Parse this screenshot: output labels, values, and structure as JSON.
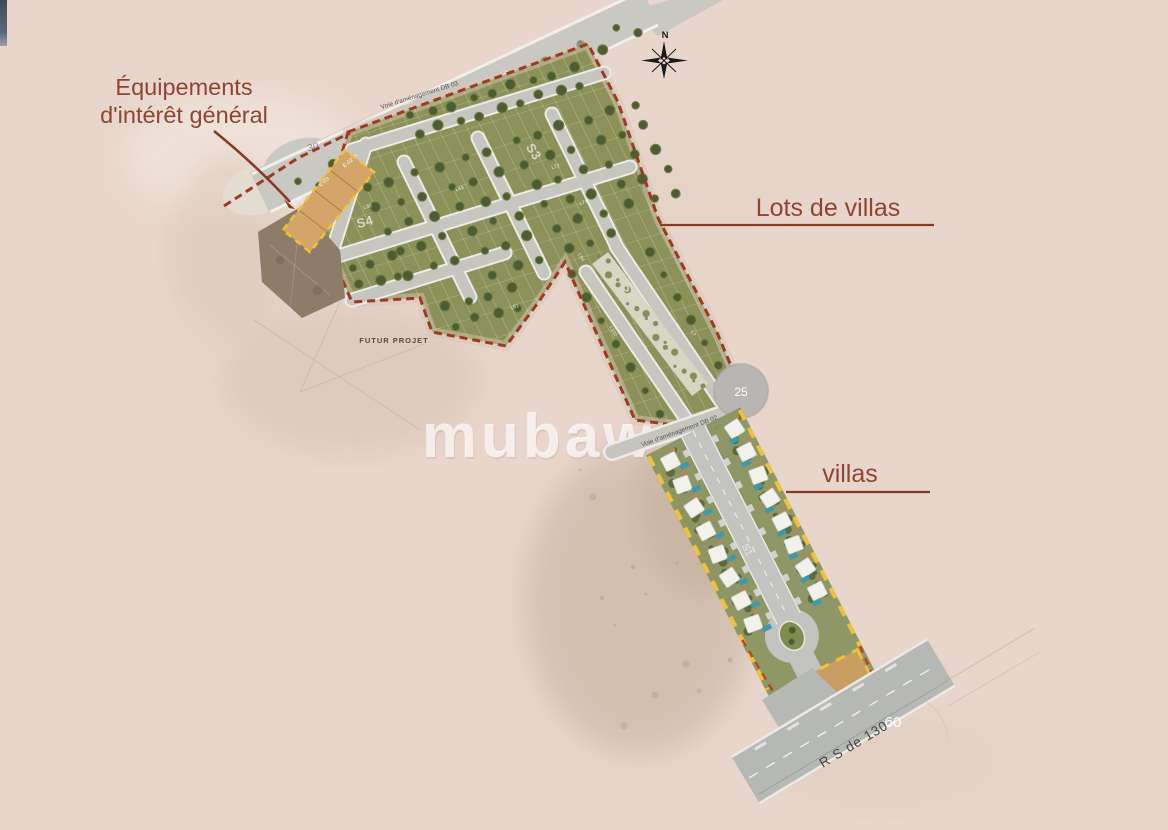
{
  "page": {
    "background": "#e8d6cc",
    "corner_sliver_color": "#55606f"
  },
  "watermark": {
    "text": "mubaw"
  },
  "compass": {
    "north_label": "N"
  },
  "callouts": {
    "equipements": {
      "line1": "Équipements",
      "line2": "d'intérêt général"
    },
    "lots_de_villas": {
      "label": "Lots de villas"
    },
    "villas": {
      "label": "villas"
    }
  },
  "map": {
    "sectors": {
      "s1": "S1",
      "s2": "S2",
      "s3": "S3",
      "s4": "S4"
    },
    "equipment_lot_labels": [
      "E-02",
      "E-03",
      "E-04"
    ],
    "road_labels": {
      "top_road": "Voie d'aménagement DB 03",
      "villas_road": "Voie d'aménagement DB 02",
      "regional_road": "R S de 130"
    },
    "measurements": {
      "top_road_width": "30",
      "roundabout": "25",
      "regional_road_width": "60"
    },
    "annotations": {
      "future_project": "FUTUR PROJET"
    },
    "sample_lot_labels": [
      "L20",
      "L25",
      "L30",
      "L43",
      "L51",
      "L72",
      "L77",
      "L94",
      "L102",
      "L7"
    ],
    "colors": {
      "lot_green": "#8b9158",
      "tree_green": "#4e5c32",
      "tree_ring": "#72814a",
      "road_gray": "#c6c5c0",
      "road_casing": "#edebe5",
      "boundary_red": "#9d3a20",
      "equipment_orange": "#d3a568",
      "villa_boundary_yellow": "#f0c23c",
      "existing_brown": "#8d7c68",
      "pool_teal": "#3e9aa8",
      "callout_line": "#8a3a22",
      "median_cream": "#d9d5c3",
      "shrub_green": "#55663a"
    }
  }
}
